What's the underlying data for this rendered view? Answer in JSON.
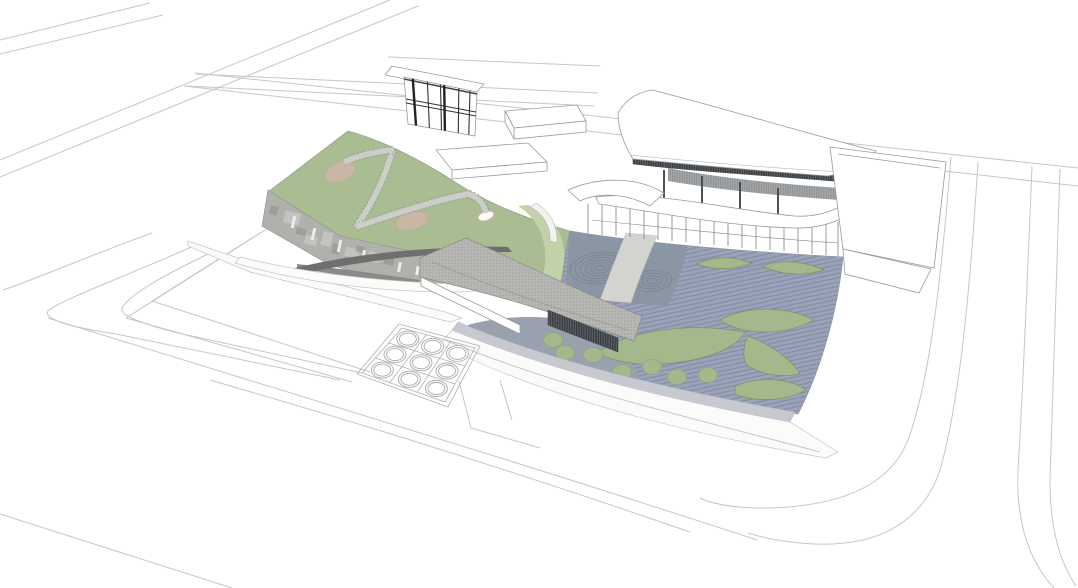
{
  "scene": {
    "description": "Aerial architectural rendering of a cultural building complex: a sloping green roof with winding ramps on the left, a folded gray tile canopy in the middle, a striped blue-gray water plaza with leaf-shaped green islands and ripple rings on the right, a curved-roof louvered pavilion at the top right, a small two-storey cube building and service boxes on the upper plaza, a 3x3 skylight grid court, all surrounded by white perspective road lines on a blank ground."
  },
  "colors": {
    "bg": "#ffffff",
    "white": "#ffffff",
    "offwhite": "#fbfbfa",
    "line_light": "#c6c6c6",
    "line_mid": "#9a9a9a",
    "green_roof": "#a9bc92",
    "green_edge": "#8a9579",
    "green_light": "#c2d1a7",
    "green_leaf": "#a3b98b",
    "leaf_edge": "#7d8d66",
    "tan_patch": "#c9b7a5",
    "plaza_blue": "#9aa3b8",
    "plaza_dark": "#8b96a4",
    "plaza_plain": "#99a1af",
    "stripe": "#7f89a3",
    "path_gray": "#d3d3d0",
    "ring": "#78828f",
    "canopy_gray": "#b6b6b3",
    "canopy_dot": "#90908d",
    "canopy_dark": "#6f6f6f",
    "facade": "#b0b0ad",
    "louver_bg": "#5c6166",
    "louver_line": "#2e3236",
    "curb": "#c6cad0"
  },
  "counts": {
    "skylight_grid_rows": 3,
    "skylight_grid_cols": 3,
    "planter_circles": 7,
    "leaf_islands": 6,
    "ripple_ring_groups": 2,
    "green_mounds": 2,
    "roof_ramps": 3,
    "service_boxes": 2,
    "terrace_decks": 2
  }
}
